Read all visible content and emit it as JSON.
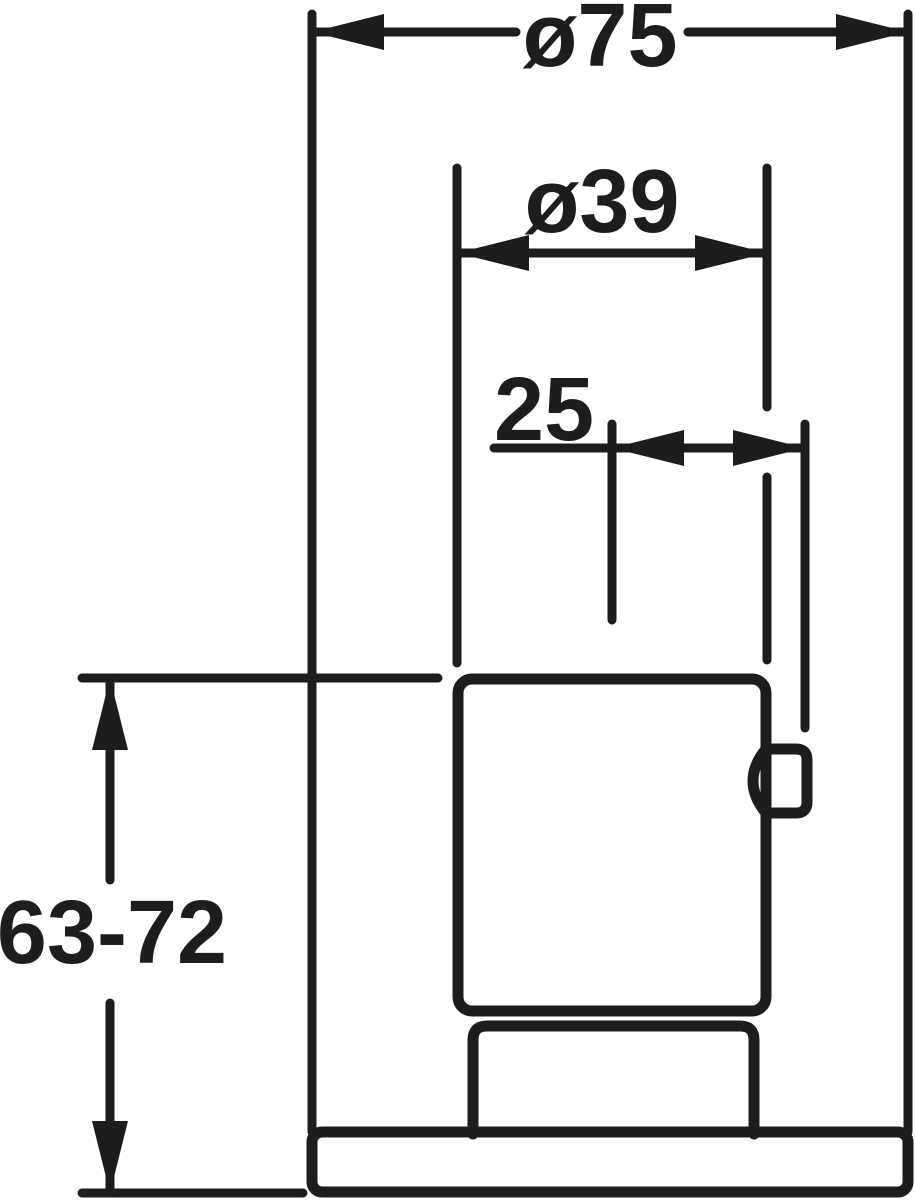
{
  "drawing": {
    "type": "technical-dimension-drawing",
    "background_color": "#ffffff",
    "ink_color": "#1d1d1b",
    "part": "valve-trim-side-view",
    "dimensions": {
      "outer_diameter": {
        "label": "ø75",
        "kind": "diameter",
        "value": 75
      },
      "body_diameter": {
        "label": "ø39",
        "kind": "diameter",
        "value": 39
      },
      "handle_offset": {
        "label": "25",
        "kind": "linear",
        "value": 25
      },
      "mounting_depth_range": {
        "label": "63-72",
        "kind": "linear_range",
        "min": 63,
        "max": 72
      }
    }
  }
}
